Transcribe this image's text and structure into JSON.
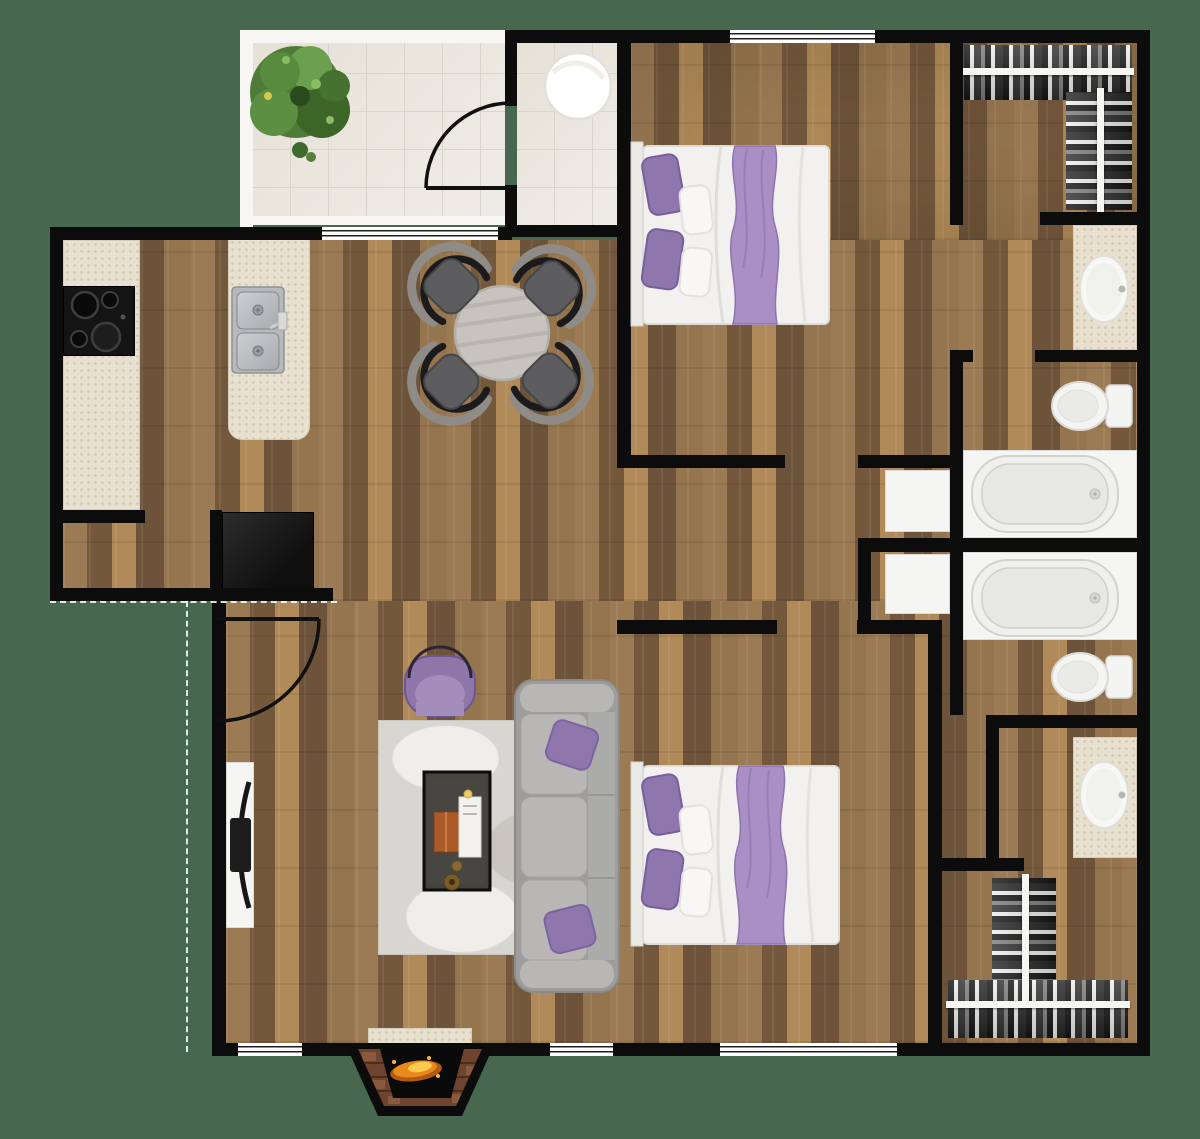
{
  "plan": {
    "name": "Two-Bedroom Apartment Floor Plan",
    "view": "top-down 2D render",
    "width_px": 1200,
    "height_px": 1139
  },
  "colors": {
    "bg": "#47684e",
    "wall": "#0c0c0c",
    "wood_base": "#8d7150",
    "wood_dark": "#74583c",
    "wood_mid": "#9c7b54",
    "wood_light": "#b08a58",
    "tile": "#ebe8e2",
    "tile_line": "#d9d5cc",
    "frame_white": "#f7f6f3",
    "beige": "#e8e1d0",
    "beige_edge": "#d5cdb9",
    "steel": "#b7babc",
    "steel_edge": "#8f9295",
    "fixture_white": "#f5f5f3",
    "fixture_edge": "#dcdbd7",
    "tub_fill": "#f0f0ee",
    "tub_inner": "#e7e7e4",
    "tub_edge": "#d2d2cf",
    "sofa_base": "#9e9d9b",
    "sofa_light": "#b8b7b5",
    "sofa_mid": "#ababa9",
    "purple": "#8f76ad",
    "purple_dark": "#76609c",
    "purple_light": "#a98fc4",
    "rug_base": "#d8d6d0",
    "rug_light": "#efeeea",
    "rug_dark": "#c9c6c0",
    "coffee_table": "#44433c",
    "chair_seat": "#5d5d60",
    "chair_back": "#1b1b1e",
    "chair_frame": "#8f8c88",
    "dining_table": "#c7c4c0",
    "dining_table_edge": "#b2afab",
    "cloth_dark": "#151515",
    "cloth_light": "#efefed",
    "cloth_gray": "#7d7d7b",
    "brick": "#6e4430",
    "brick_dark": "#4c2e1e",
    "brick_light": "#8a5a3f",
    "flame_orange": "#e8891c",
    "flame_yellow": "#ffc94d",
    "plant_green_1": "#4e7c38",
    "plant_green_2": "#3c6527",
    "plant_green_3": "#5c8f42",
    "plant_green_4": "#6aa04e",
    "plant_green_5": "#8abc62"
  },
  "rooms": [
    {
      "key": "balcony",
      "name": "Balcony / Patio"
    },
    {
      "key": "utility",
      "name": "Utility Room"
    },
    {
      "key": "kitchen",
      "name": "Kitchen"
    },
    {
      "key": "dining",
      "name": "Dining Area"
    },
    {
      "key": "living",
      "name": "Living Room"
    },
    {
      "key": "hallway",
      "name": "Hallway"
    },
    {
      "key": "bedroom-1",
      "name": "Bedroom 1"
    },
    {
      "key": "closet-1",
      "name": "Walk-in Closet 1"
    },
    {
      "key": "vanity-1",
      "name": "Vanity 1"
    },
    {
      "key": "bathroom-1",
      "name": "Bathroom 1"
    },
    {
      "key": "bedroom-2",
      "name": "Bedroom 2"
    },
    {
      "key": "bathroom-2",
      "name": "Bathroom 2"
    },
    {
      "key": "vanity-2",
      "name": "Vanity 2"
    },
    {
      "key": "closet-2",
      "name": "Walk-in Closet 2"
    }
  ],
  "furniture": {
    "plant": "Potted Plant",
    "round_fixture": "Round Fixture",
    "cooktop": "4-Burner Cooktop",
    "counter": "Kitchen Counter",
    "island": "Kitchen Island",
    "kitchen_sink": "Double Kitchen Sink",
    "refrigerator": "Refrigerator",
    "dining_table": "Round Dining Table",
    "dining_chair": "Dining Chair",
    "bed_1": "Double Bed 1",
    "bed_2": "Double Bed 2",
    "closet_rod": "Closet Rod with Hanging Clothes",
    "vanity_sink": "Vanity Sink",
    "toilet": "Toilet",
    "bathtub": "Bathtub",
    "linen_cabinet": "Linen Cabinet",
    "sofa": "Three-Seat Sofa",
    "armchair": "Accent Armchair",
    "coffee_table": "Coffee Table",
    "area_rug": "Area Rug",
    "tv": "Wall-Mounted TV",
    "fireplace": "Wood-Burning Fireplace",
    "window": "Window",
    "sliding_door": "Sliding Glass Door",
    "door": "Swing Door"
  }
}
